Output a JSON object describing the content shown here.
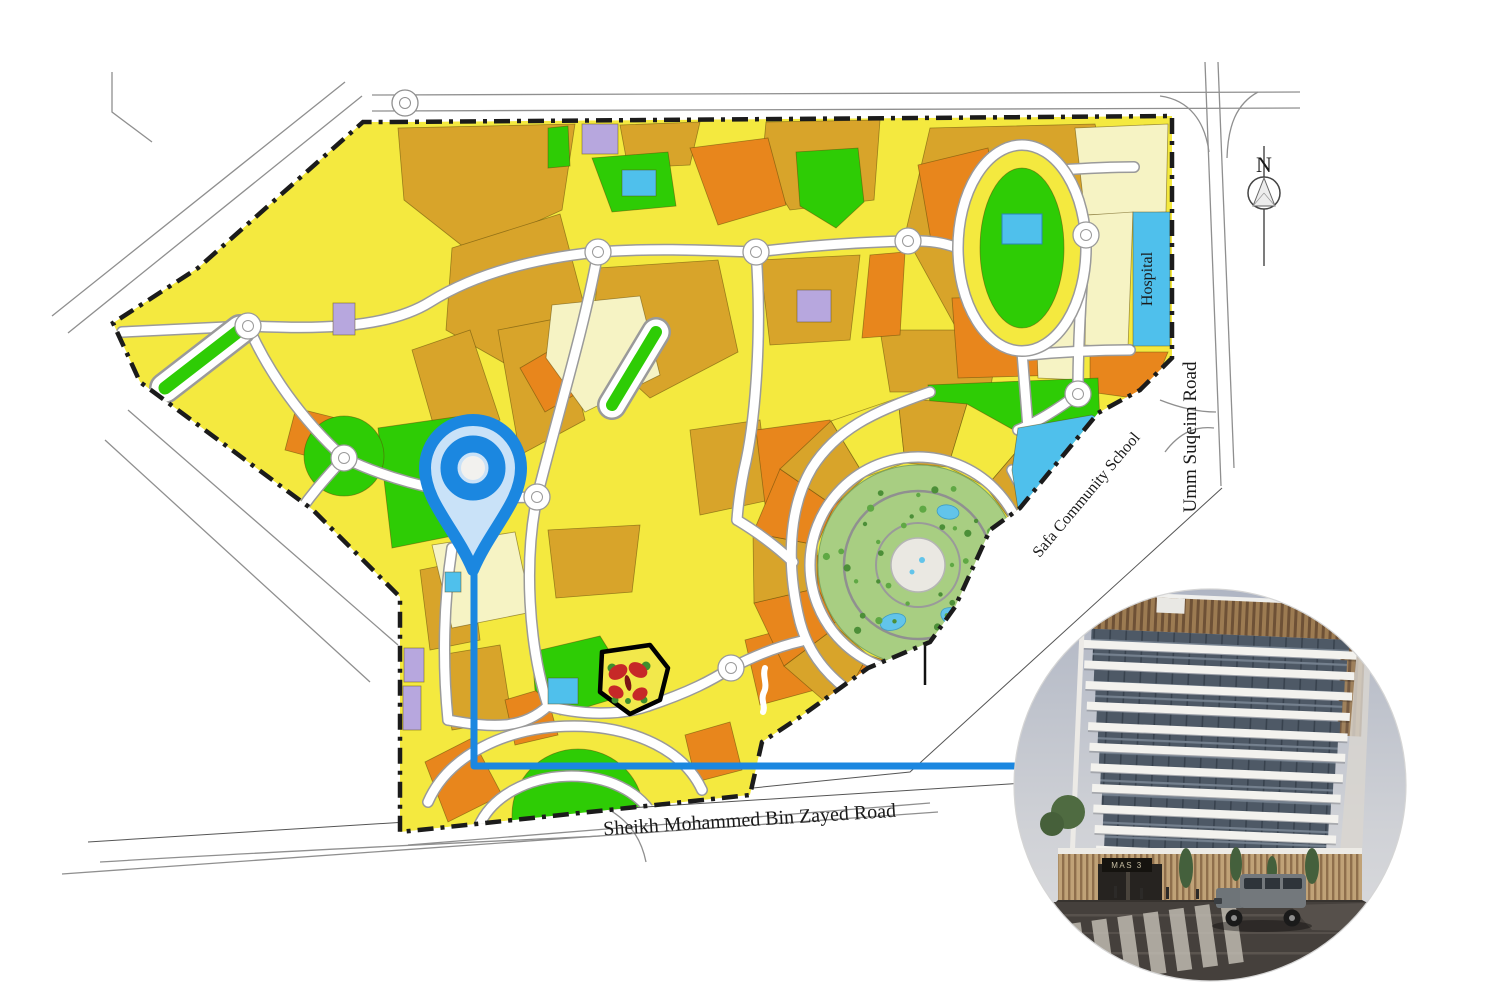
{
  "map": {
    "parcel_labels": {
      "hospital": "Hospital",
      "school": "Safa Community School"
    },
    "road_labels": {
      "umm_suqeim": "Umm Suqeim Road",
      "smbz": "Sheikh Mohammed Bin Zayed Road"
    },
    "compass_label": "N",
    "colors": {
      "yellow": "#F4E93F",
      "gold": "#D8A42A",
      "orange": "#E8861C",
      "green": "#2ECC05",
      "cream": "#F6F3C4",
      "blue": "#4FC0EC",
      "purple": "#B7A7DE",
      "park_green": "#A8CE82",
      "pond_blue": "#62C4EA",
      "sand": "#D8C8A2",
      "road_fill": "#FFFFFF",
      "road_casing": "#9A9A9A",
      "boundary": "#1B1B1B",
      "pin_blue": "#1B87E0",
      "pin_fill": "#C9E2F8"
    }
  },
  "inset": {
    "sign_text": "MAS 3"
  }
}
